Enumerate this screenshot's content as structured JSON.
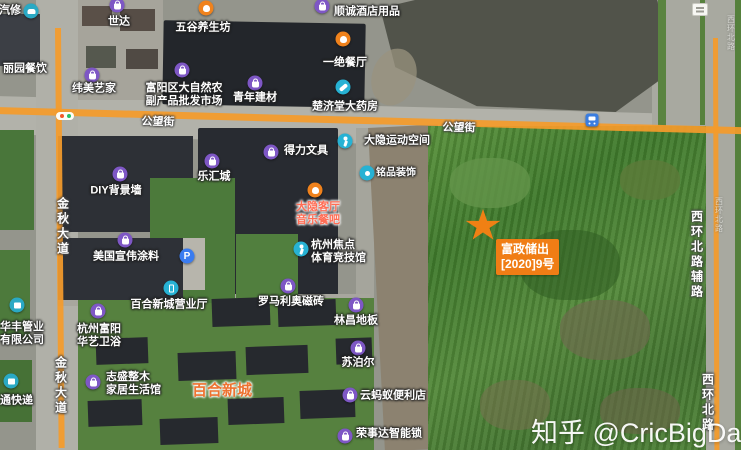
{
  "watermark": {
    "text": "知乎 @CricBigData"
  },
  "parcel_marker": {
    "line1": "富政储出",
    "line2": "[2020]9号",
    "color": "#f07d15"
  },
  "colors": {
    "road_overlay": "#f49b2b",
    "poi_shop": "#7e57c5",
    "poi_food": "#f0821c",
    "poi_service": "#27b2d4",
    "poi_parking": "#3a7cf0",
    "parcel_accent": "#f08014",
    "area_label": "#ee7230"
  },
  "road_labels": [
    {
      "name": "gongwang-street-left",
      "text": "公望街",
      "x": 158,
      "y": 121,
      "vertical": false,
      "rotate": 1.5
    },
    {
      "name": "gongwang-street-right",
      "text": "公望街",
      "x": 459,
      "y": 127,
      "vertical": false,
      "rotate": 1.5
    },
    {
      "name": "jinqiu-avenue-upper",
      "text": "金秋大道",
      "x": 63,
      "y": 227,
      "vertical": true
    },
    {
      "name": "jinqiu-avenue-lower",
      "text": "金秋大道",
      "x": 61,
      "y": 386,
      "vertical": true
    },
    {
      "name": "xihuan-north-side-road",
      "text": "西环北路辅路",
      "x": 697,
      "y": 255,
      "vertical": true
    },
    {
      "name": "xihuan-north-road",
      "text": "西环北路",
      "x": 708,
      "y": 403,
      "vertical": true
    },
    {
      "name": "xihuan-north-road-faint-mid",
      "text": "西环北路",
      "x": 719,
      "y": 215,
      "vertical": true,
      "faint": true
    },
    {
      "name": "xihuan-north-road-faint-top",
      "text": "西环北路",
      "x": 731,
      "y": 33,
      "vertical": true,
      "faint": true
    }
  ],
  "pois": [
    {
      "name": "auto-repair",
      "icon": {
        "type": "car",
        "x": 31,
        "y": 11
      },
      "label": {
        "lines": [
          "汽修"
        ],
        "x": 10,
        "y": 11
      }
    },
    {
      "name": "shida",
      "icon": {
        "type": "shop",
        "x": 117,
        "y": 5
      },
      "label": {
        "lines": [
          "世达"
        ],
        "x": 119,
        "y": 22
      }
    },
    {
      "name": "wugu-health-shop",
      "icon": {
        "type": "food",
        "x": 206,
        "y": 8
      },
      "label": {
        "lines": [
          "五谷养生坊"
        ],
        "x": 203,
        "y": 28
      }
    },
    {
      "name": "shuncheng-hotel-supplies",
      "icon": {
        "type": "shop",
        "x": 322,
        "y": 6
      },
      "label": {
        "lines": [
          "顺诚酒店用品"
        ],
        "x": 367,
        "y": 12
      }
    },
    {
      "name": "liyuan-restaurant",
      "icon": null,
      "label": {
        "lines": [
          "丽园餐饮"
        ],
        "x": 25,
        "y": 69
      }
    },
    {
      "name": "weimei-yijia",
      "icon": {
        "type": "shop",
        "x": 92,
        "y": 75
      },
      "label": {
        "lines": [
          "纬美艺家"
        ],
        "x": 94,
        "y": 89
      }
    },
    {
      "name": "fuyang-farm-produce-market",
      "icon": {
        "type": "shop",
        "x": 182,
        "y": 70
      },
      "label": {
        "lines": [
          "富阳区大自然农",
          "副产品批发市场"
        ],
        "x": 184,
        "y": 95
      }
    },
    {
      "name": "qingnian-building-materials",
      "icon": {
        "type": "shop",
        "x": 255,
        "y": 83
      },
      "label": {
        "lines": [
          "青年建材"
        ],
        "x": 255,
        "y": 98
      }
    },
    {
      "name": "yijue-restaurant",
      "icon": {
        "type": "food",
        "x": 343,
        "y": 39
      },
      "label": {
        "lines": [
          "一绝餐厅"
        ],
        "x": 345,
        "y": 63
      }
    },
    {
      "name": "chujitang-pharmacy",
      "icon": {
        "type": "med",
        "x": 343,
        "y": 87
      },
      "label": {
        "lines": [
          "楚济堂大药房"
        ],
        "x": 345,
        "y": 107
      }
    },
    {
      "name": "deli-stationery",
      "icon": {
        "type": "shop",
        "x": 271,
        "y": 152
      },
      "label": {
        "lines": [
          "得力文具"
        ],
        "x": 306,
        "y": 151
      }
    },
    {
      "name": "dayin-sports-space",
      "icon": {
        "type": "sport",
        "x": 345,
        "y": 141
      },
      "label": {
        "lines": [
          "大隐运动空间"
        ],
        "x": 397,
        "y": 141
      }
    },
    {
      "name": "mingpin-decoration",
      "icon": {
        "type": "dot",
        "x": 367,
        "y": 173
      },
      "label": {
        "lines": [
          "铭品装饰"
        ],
        "x": 396,
        "y": 173,
        "size": 10
      }
    },
    {
      "name": "lehui-city",
      "icon": {
        "type": "shop",
        "x": 212,
        "y": 161
      },
      "label": {
        "lines": [
          "乐汇城"
        ],
        "x": 214,
        "y": 177
      }
    },
    {
      "name": "diy-background-wall",
      "icon": {
        "type": "shop",
        "x": 120,
        "y": 174
      },
      "label": {
        "lines": [
          "DIY背景墙"
        ],
        "x": 116,
        "y": 191
      }
    },
    {
      "name": "dayin-music-restaurant",
      "icon": {
        "type": "food",
        "x": 315,
        "y": 190
      },
      "label": {
        "lines": [
          "大隐客厅",
          "音乐餐吧"
        ],
        "x": 318,
        "y": 214,
        "color": "#ff6d55",
        "outline": "light"
      }
    },
    {
      "name": "hangzhou-focus-sports-arena",
      "icon": {
        "type": "sport",
        "x": 301,
        "y": 249
      },
      "label": {
        "lines": [
          "杭州焦点",
          "体育竞技馆"
        ],
        "x": 311,
        "y": 252,
        "align": "left"
      }
    },
    {
      "name": "sherwin-williams-paint",
      "icon": {
        "type": "shop",
        "x": 125,
        "y": 240
      },
      "label": {
        "lines": [
          "美国宣伟涂料"
        ],
        "x": 126,
        "y": 257
      }
    },
    {
      "name": "parking-lot",
      "icon": {
        "type": "parking",
        "x": 187,
        "y": 256
      },
      "label": null
    },
    {
      "name": "baihe-xincheng-business-hall",
      "icon": {
        "type": "mobile",
        "x": 171,
        "y": 288
      },
      "label": {
        "lines": [
          "百合新城营业厅"
        ],
        "x": 169,
        "y": 305
      }
    },
    {
      "name": "huafeng-pipe-company",
      "icon": {
        "type": "tool",
        "x": 17,
        "y": 305
      },
      "label": {
        "lines": [
          "华丰管业",
          "有限公司"
        ],
        "x": 0,
        "y": 334,
        "align": "left"
      }
    },
    {
      "name": "hangzhou-huayi-bathroom",
      "icon": {
        "type": "shop",
        "x": 98,
        "y": 311
      },
      "label": {
        "lines": [
          "杭州富阳",
          "华艺卫浴"
        ],
        "x": 77,
        "y": 336,
        "align": "left"
      }
    },
    {
      "name": "express-delivery",
      "icon": {
        "type": "express",
        "x": 11,
        "y": 381
      },
      "label": {
        "lines": [
          "通快递"
        ],
        "x": 0,
        "y": 401,
        "align": "left"
      }
    },
    {
      "name": "baihe-xincheng-area",
      "icon": null,
      "label": {
        "lines": [
          "百合新城"
        ],
        "x": 222,
        "y": 391,
        "size": 15,
        "color": "#ee7230",
        "outline": "light"
      }
    },
    {
      "name": "zhisheng-wood-home",
      "icon": {
        "type": "shop",
        "x": 93,
        "y": 382
      },
      "label": {
        "lines": [
          "志盛整木",
          "家居生活馆"
        ],
        "x": 106,
        "y": 384,
        "align": "left"
      }
    },
    {
      "name": "romario-tiles",
      "icon": {
        "type": "shop",
        "x": 288,
        "y": 286
      },
      "label": {
        "lines": [
          "罗马利奥磁砖"
        ],
        "x": 291,
        "y": 302
      }
    },
    {
      "name": "linchang-flooring",
      "icon": {
        "type": "shop",
        "x": 356,
        "y": 305
      },
      "label": {
        "lines": [
          "林昌地板"
        ],
        "x": 356,
        "y": 321
      }
    },
    {
      "name": "supor",
      "icon": {
        "type": "shop",
        "x": 358,
        "y": 348
      },
      "label": {
        "lines": [
          "苏泊尔"
        ],
        "x": 358,
        "y": 363
      }
    },
    {
      "name": "yunmayi-convenience-store",
      "icon": {
        "type": "shop",
        "x": 350,
        "y": 395
      },
      "label": {
        "lines": [
          "云蚂蚁便利店"
        ],
        "x": 393,
        "y": 396
      }
    },
    {
      "name": "royalstar-smart-lock",
      "icon": {
        "type": "shop",
        "x": 345,
        "y": 436
      },
      "label": {
        "lines": [
          "荣事达智能锁"
        ],
        "x": 389,
        "y": 434
      }
    },
    {
      "name": "bus-station",
      "icon": {
        "type": "bus",
        "x": 592,
        "y": 120
      },
      "label": null
    }
  ]
}
